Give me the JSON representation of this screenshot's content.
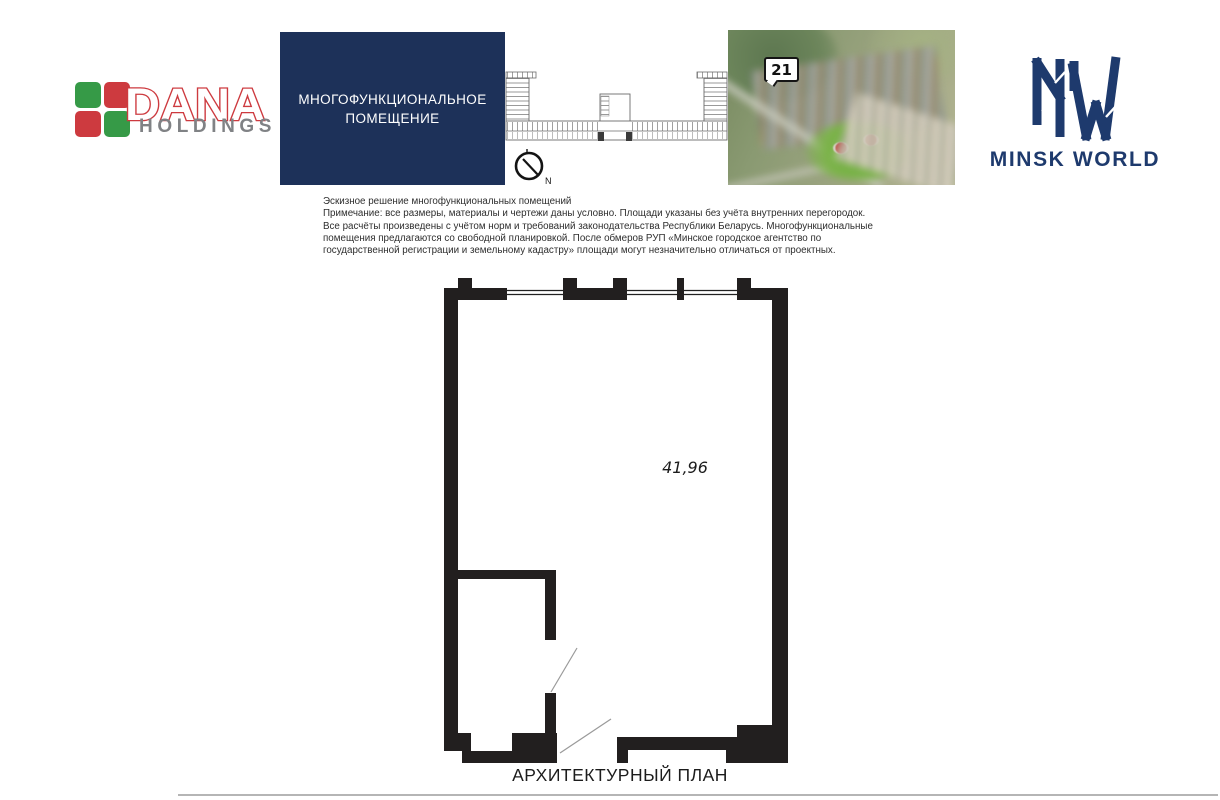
{
  "header": {
    "dana": {
      "brand": "DANA",
      "holdings": "HOLDINGS",
      "green": "#369a47",
      "red": "#cd3a3f",
      "gray": "#808285"
    },
    "title_box": {
      "text": "МНОГОФУНКЦИОНАЛЬНОЕ ПОМЕЩЕНИЕ",
      "bg": "#1d3159"
    },
    "key_plan": {
      "compass_label": "N"
    },
    "aerial": {
      "marker_label": "21"
    },
    "mw": {
      "wordmark": "MINSK WORLD",
      "navy": "#1e3a6d"
    }
  },
  "notes": {
    "lines": [
      "Эскизное решение многофункциональных помещений",
      "Примечание: все размеры, материалы и чертежи даны условно. Площади указаны без учёта внутренних перегородок.",
      "Все расчёты произведены с учётом норм и требований законодательства Республики Беларусь. Многофункциональные",
      "помещения предлагаются со свободной планировкой. После обмеров РУП «Минское городское агентство по",
      "государственной регистрации и земельному кадастру» площади могут незначительно отличаться от проектных."
    ]
  },
  "floor_plan": {
    "area_label": "41,96",
    "caption": "АРХИТЕКТУРНЫЙ ПЛАН",
    "wall_color": "#221f1f"
  }
}
